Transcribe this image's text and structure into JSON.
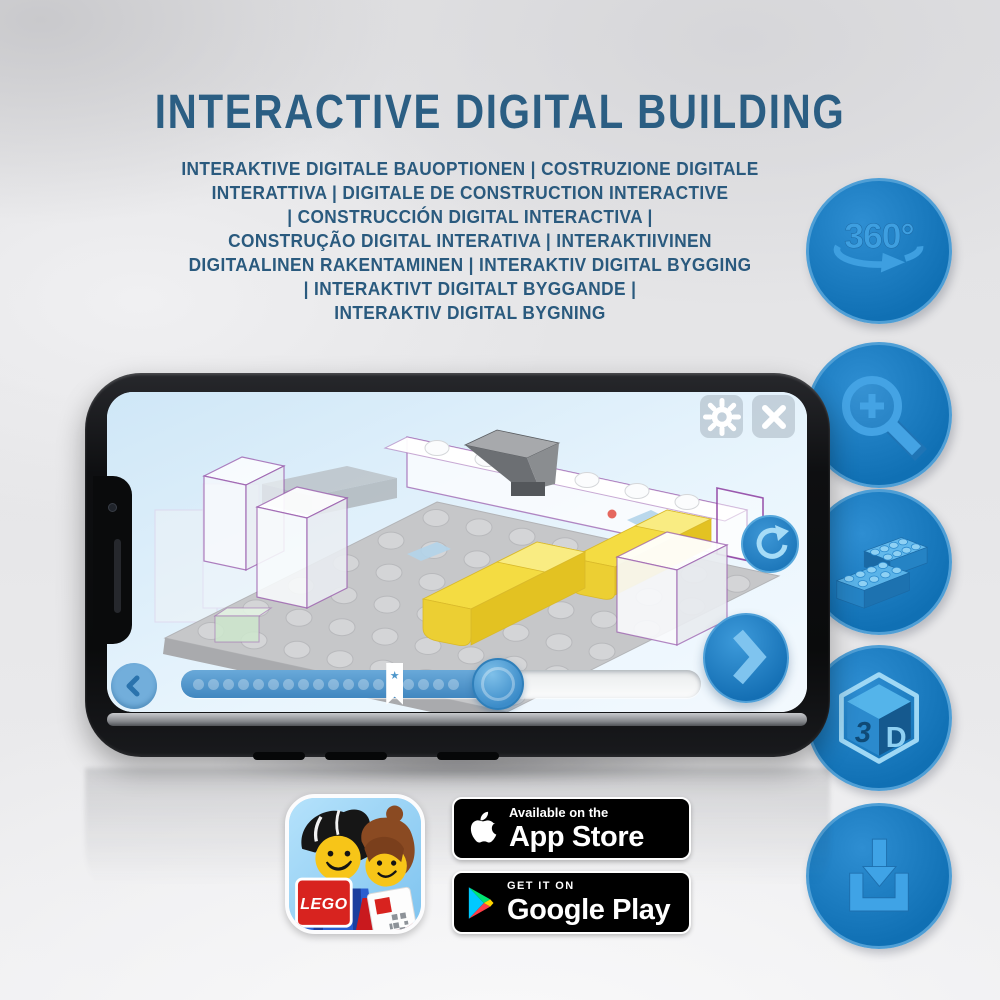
{
  "title": "INTERACTIVE DIGITAL BUILDING",
  "subtitle": {
    "lines": [
      "INTERAKTIVE DIGITALE BAUOPTIONEN | COSTRUZIONE DIGITALE",
      "INTERATTIVA | DIGITALE DE CONSTRUCTION INTERACTIVE",
      "| CONSTRUCCIÓN DIGITAL INTERACTIVA |",
      "CONSTRUÇÃO DIGITAL INTERATIVA | INTERAKTIIVINEN",
      "DIGITAALINEN RAKENTAMINEN | INTERAKTIV DIGITAL BYGGING",
      "| INTERAKTIVT DIGITALT BYGGANDE |",
      "INTERAKTIV DIGITAL BYGNING"
    ]
  },
  "feature_icons": {
    "rotate_360": {
      "label": "360°"
    },
    "cube_3d": {
      "left": "3",
      "right": "D"
    }
  },
  "phone": {
    "progress": {
      "percent": 61,
      "bookmark_percent": 41,
      "dot_count": 18
    }
  },
  "badges": {
    "app_store": {
      "tagline": "Available on the",
      "store": "App Store"
    },
    "google_play": {
      "tagline": "GET IT ON",
      "store": "Google Play"
    }
  },
  "app_icon": {
    "brand": "LEGO"
  },
  "colors": {
    "heading": "#2b5e83",
    "subheading": "#2a5a7e",
    "accent_blue": "#1070b4",
    "icon_glyph_blue": "#3e9fe0",
    "lego_yellow": "#f4dc42",
    "screen_sky": "#cfe7f7",
    "badge_black": "#000000"
  }
}
